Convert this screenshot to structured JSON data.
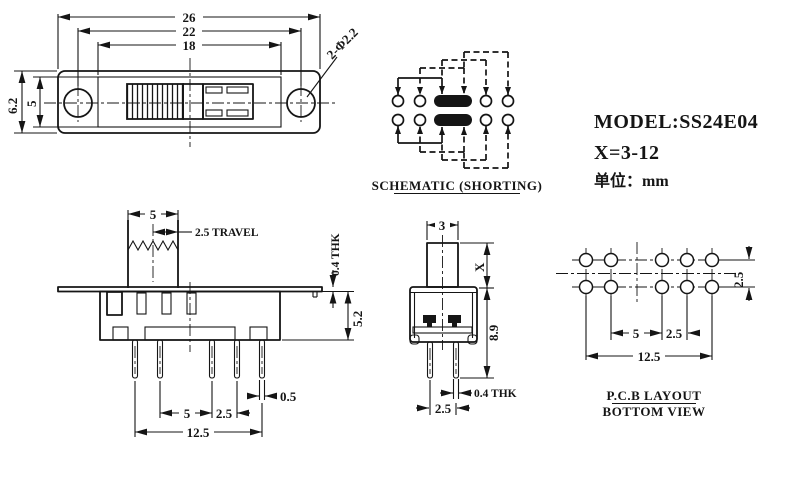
{
  "info": {
    "model": "MODEL:SS24E04",
    "x_range": "X=3-12",
    "unit": "单位：mm"
  },
  "top_view": {
    "dim_26": "26",
    "dim_22": "22",
    "dim_18": "18",
    "dim_height": "6.2",
    "dim_slot_height": "5",
    "hole_callout": "2-Φ2.2"
  },
  "schematic": {
    "caption": "SCHEMATIC (SHORTING)"
  },
  "front_view": {
    "dim_knob": "5",
    "dim_travel": "2.5 TRAVEL",
    "dim_plate": "0.4 THK",
    "dim_body": "5.2",
    "dim_pin_width": "0.5",
    "dim_pitch": "5",
    "dim_pitch_small": "2.5",
    "dim_span": "12.5"
  },
  "side_view": {
    "dim_knob": "3",
    "dim_stem": "X",
    "dim_body": "8.9",
    "dim_pin": "0.4 THK",
    "dim_pitch": "2.5"
  },
  "pcb": {
    "caption_line1": "P.C.B LAYOUT",
    "caption_line2": "BOTTOM VIEW",
    "dim_row": "2.5",
    "dim_pitch": "5",
    "dim_pitch_small": "2.5",
    "dim_span": "12.5"
  },
  "colors": {
    "line": "#151515",
    "background": "#ffffff"
  }
}
